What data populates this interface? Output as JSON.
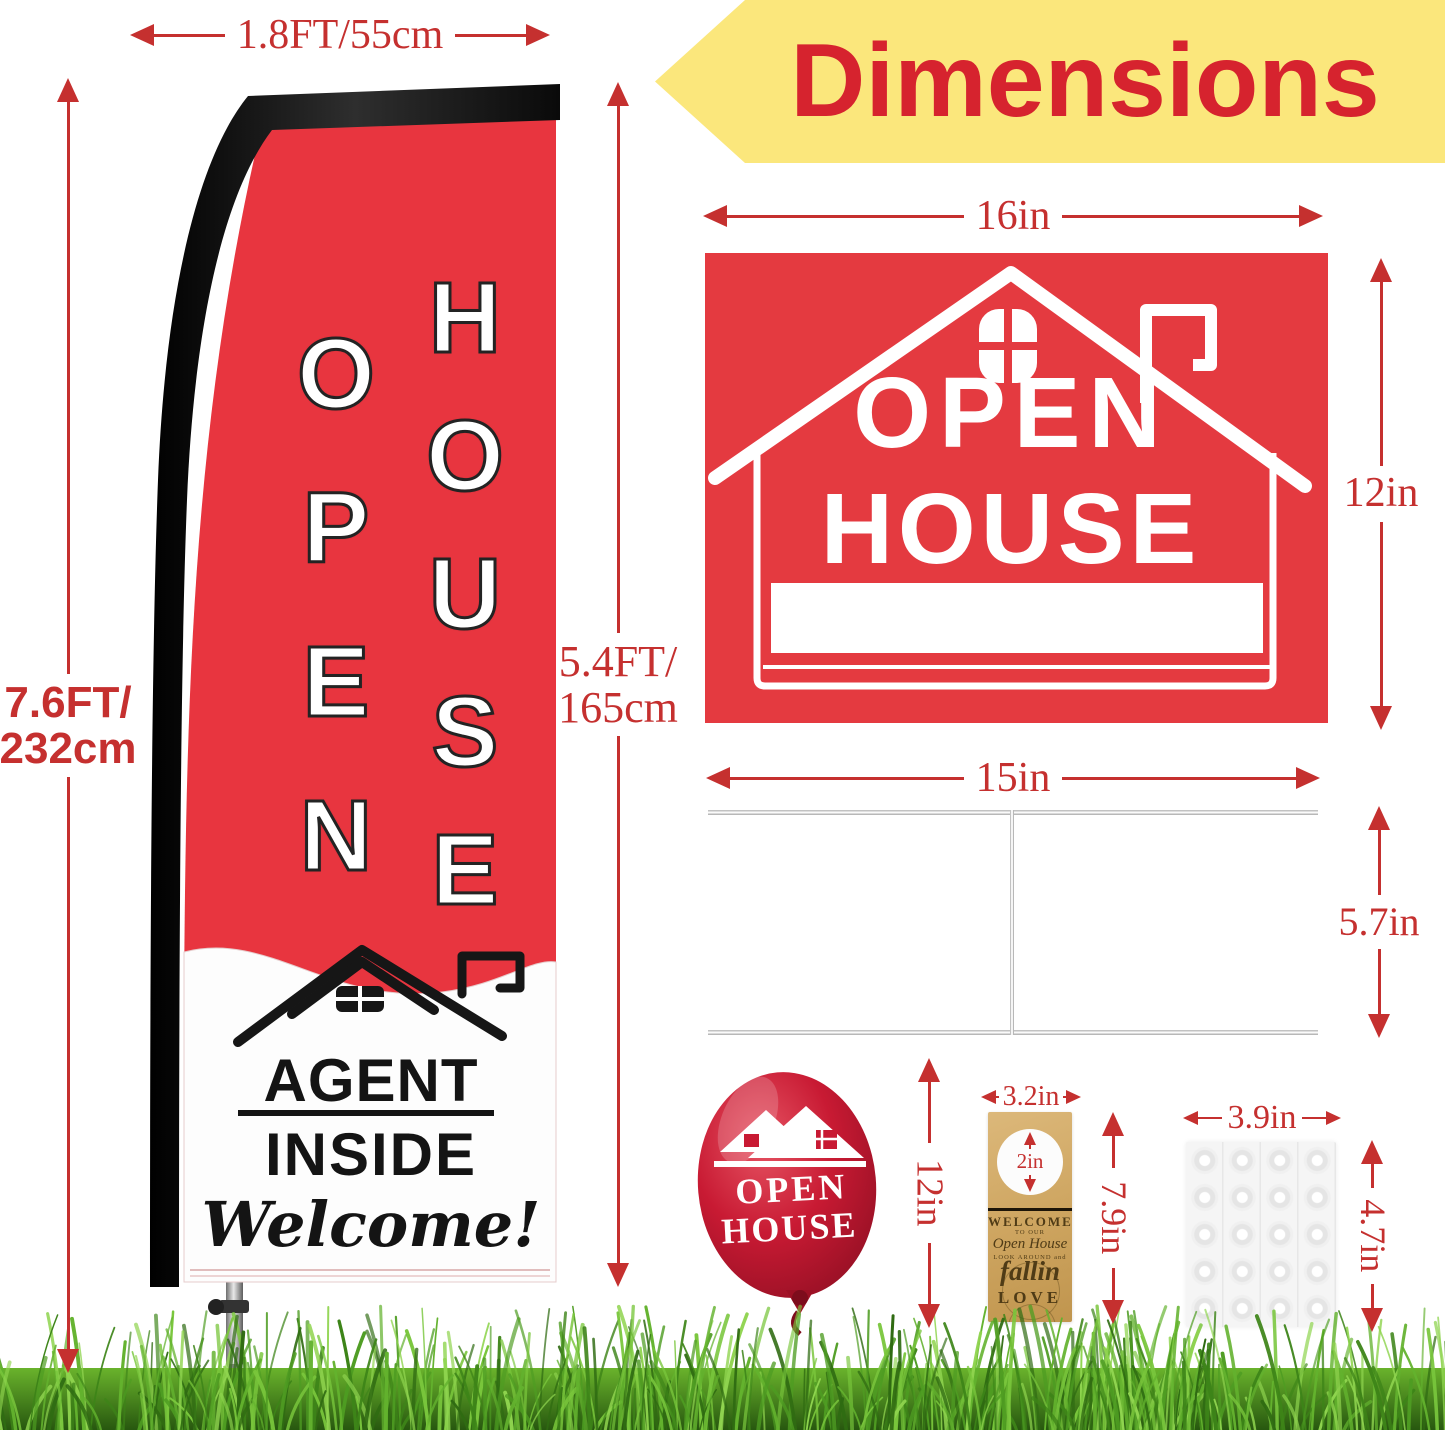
{
  "header": {
    "title": "Dimensions",
    "banner_color": "#fbe77c",
    "title_color": "#d6232e"
  },
  "dimension_color": "#c5302f",
  "flag": {
    "width_label": "1.8FT/55cm",
    "total_height": {
      "line1": "7.6FT/",
      "line2": "232cm"
    },
    "fabric_height": {
      "line1": "5.4FT/",
      "line2": "165cm"
    },
    "word_left": "OPEN",
    "word_right": "HOUSE",
    "panel": {
      "line1": "AGENT",
      "line2": "INSIDE",
      "script": "Welcome!"
    },
    "red": "#e8353f"
  },
  "sign": {
    "width_label": "16in",
    "height_label": "12in",
    "line1": "OPEN",
    "line2": "HOUSE",
    "red": "#e43a40"
  },
  "stake": {
    "width_label": "15in",
    "height_label": "5.7in"
  },
  "balloon": {
    "height_label": "12in",
    "line1": "OPEN",
    "line2": "HOUSE",
    "red": "#c0172f"
  },
  "door_hanger": {
    "width_label": "3.2in",
    "hole_label": "2in",
    "height_label": "7.9in",
    "line1": "WELCOME",
    "line2": "TO OUR",
    "line3": "Open House",
    "line4": "LOOK AROUND and",
    "line5": "fallin",
    "line6": "LOVE"
  },
  "adhesive_dots": {
    "width_label": "3.9in",
    "height_label": "4.7in"
  }
}
